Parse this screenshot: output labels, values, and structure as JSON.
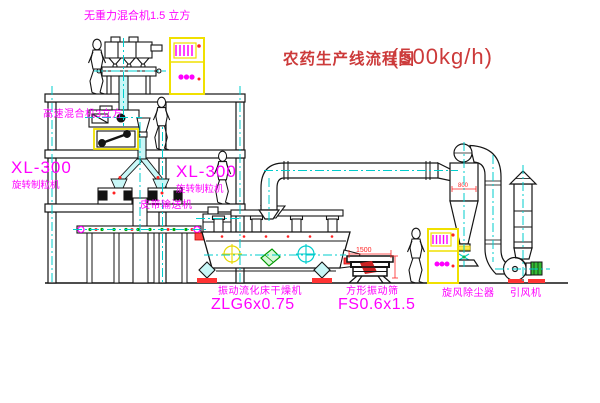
{
  "title": {
    "text": "农药生产线流程图",
    "capacity": "(500kg/h)"
  },
  "equipment_labels": {
    "gravity_mixer": "无重力混合机1.5 立方",
    "high_speed_mixer": "高速混合机3立方",
    "granulator_model_left": "XL-300",
    "granulator_name_left": "旋转制粒机",
    "granulator_model_right": "XL-300",
    "granulator_name_right": "旋转制粒机",
    "belt_conveyor": "皮带输送机",
    "dryer_name": "振动流化床干燥机",
    "dryer_model": "ZLG6x0.75",
    "sieve_name": "方形振动筛",
    "sieve_model": "FS0.6x1.5",
    "cyclone": "旋风除尘器",
    "fan": "引风机"
  },
  "dimensions": {
    "sieve_width": "1500",
    "cyclone_diameter": "800"
  },
  "colors": {
    "label_magenta": "#ff00ff",
    "title_red": "#cc3a3a",
    "dimension_red": "#ff2222",
    "centerline_cyan": "#00cdcd",
    "cabinet_yellow": "#f0e000",
    "line_black": "#141414"
  }
}
